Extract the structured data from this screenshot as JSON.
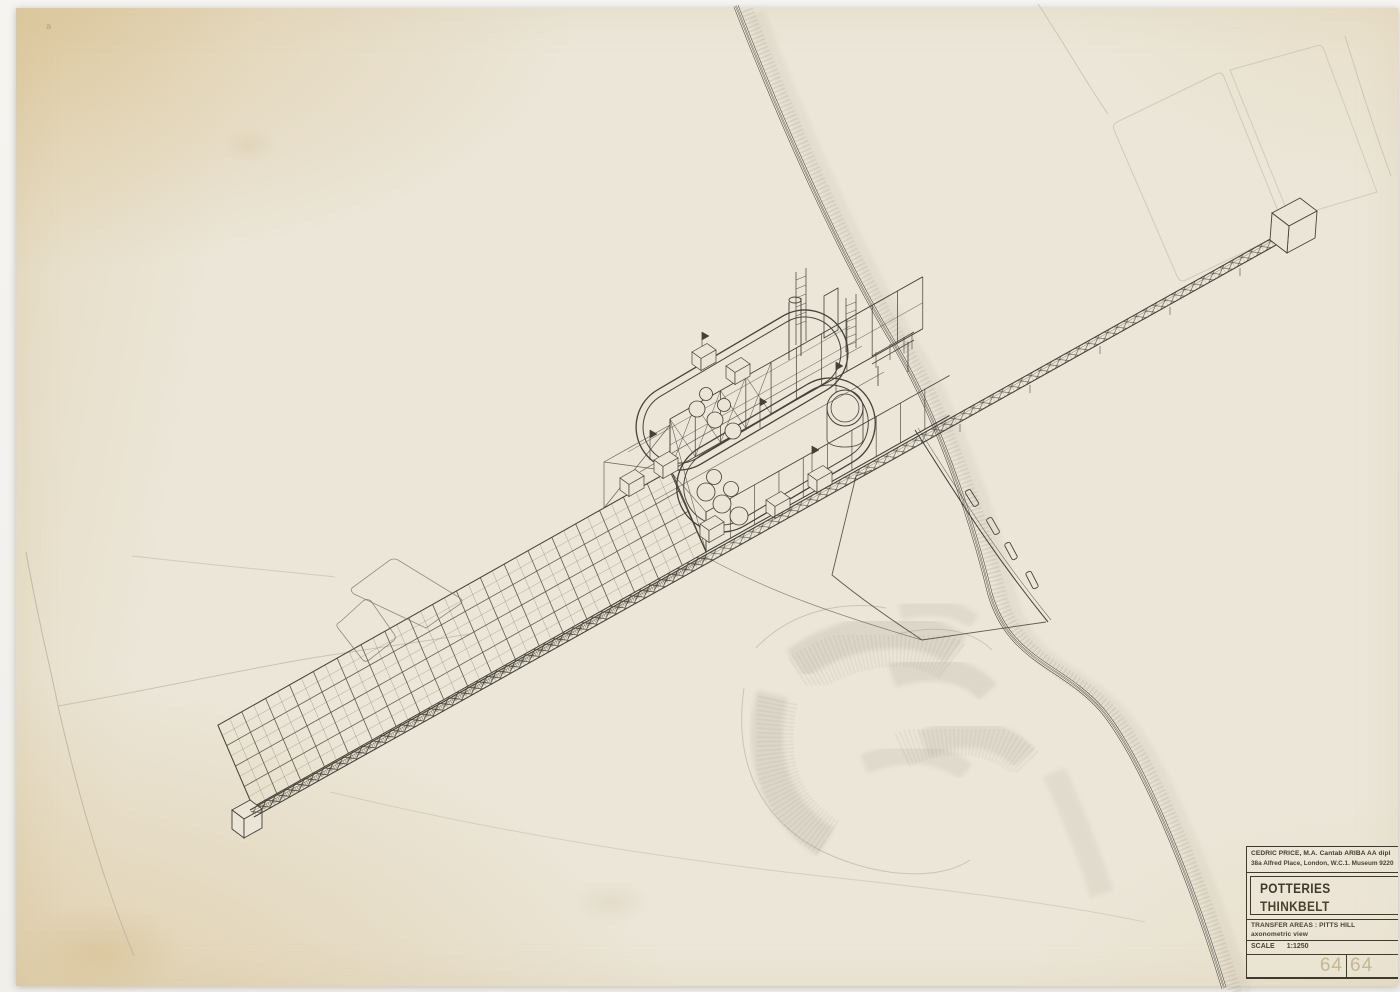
{
  "title_block": {
    "stamp": {
      "line1": "CEDRIC PRICE, M.A. Cantab ARIBA AA dipl",
      "line2": "38a Alfred Place, London, W.C.1. Museum 9220"
    },
    "project": {
      "line1": "POTTERIES",
      "line2": "THINKBELT"
    },
    "drawing": {
      "line1": "TRANSFER AREAS : PITTS HILL",
      "line2": "axonometric view"
    },
    "scale": {
      "label": "SCALE",
      "value": "1:1250"
    },
    "archive_number": {
      "left": "64",
      "right": "64"
    }
  },
  "corner_mark": "a",
  "colors": {
    "paper": "#eae5d6",
    "ink": "#45413a",
    "pencil": "#bcb49f",
    "backdrop": "#f4f2ee"
  }
}
